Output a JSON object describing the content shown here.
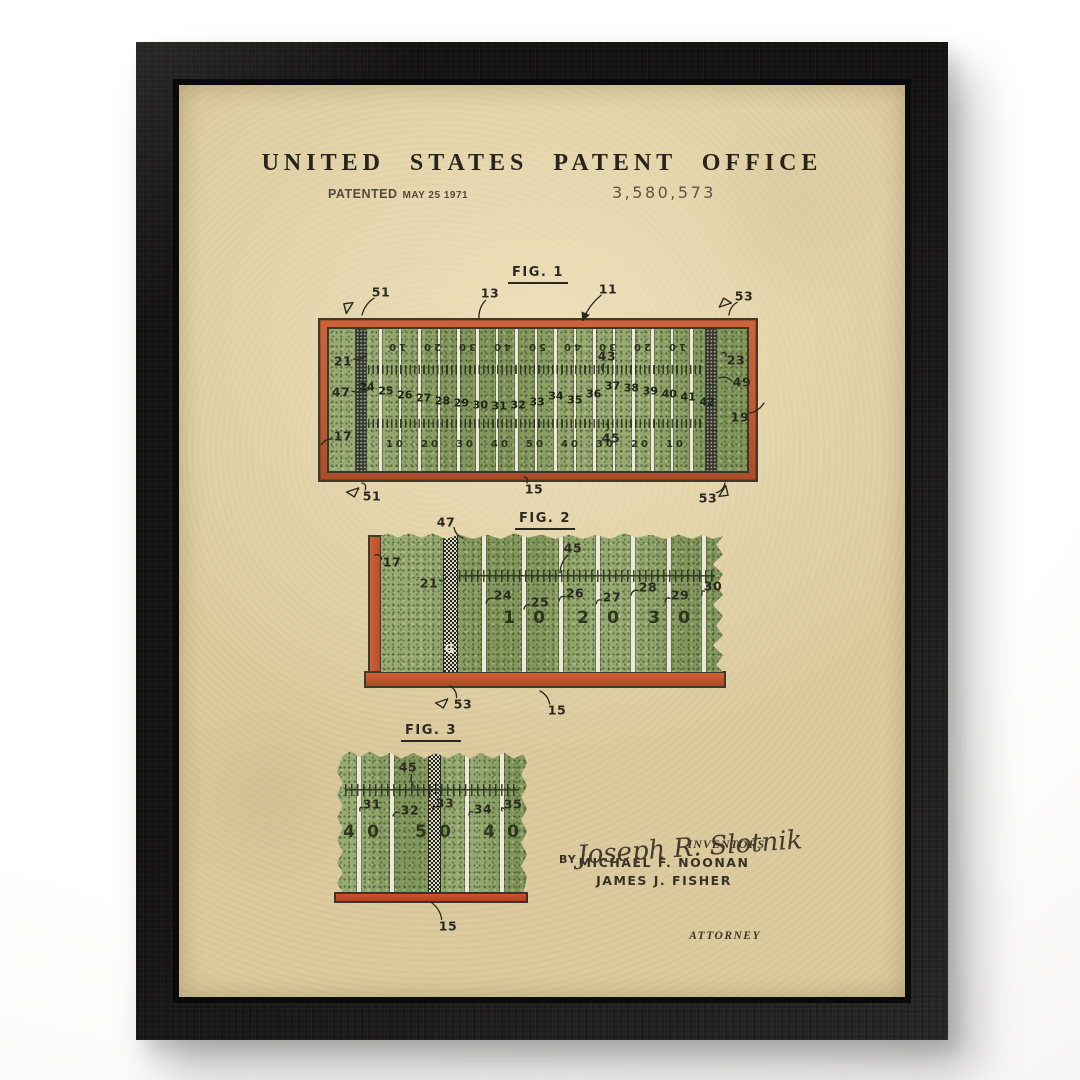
{
  "colors": {
    "frame_black": "#1b1a18",
    "paper_tan": "#dccb9f",
    "field_green": "#8ca164",
    "border_orange": "#c65c35",
    "ink_dark": "#2c2820",
    "line_cream": "#ece9d8",
    "goal_stripe_dark": "#31332a"
  },
  "header": {
    "title": "UNITED STATES PATENT OFFICE",
    "patented_label": "PATENTED",
    "patented_date": "MAY 25 1971",
    "patent_number": "3,580,573"
  },
  "figures": {
    "fig1": {
      "label": "FIG. 1",
      "top_yard_numbers": [
        "10",
        "20",
        "30",
        "40",
        "50",
        "40",
        "30",
        "20",
        "10"
      ],
      "bottom_yard_numbers": [
        "10",
        "20",
        "30",
        "40",
        "50",
        "40",
        "30",
        "20",
        "10"
      ],
      "mid_reference_numbers": [
        "24",
        "25",
        "26",
        "27",
        "28",
        "29",
        "30",
        "31",
        "32",
        "33",
        "34",
        "35",
        "36",
        "37",
        "38",
        "39",
        "40",
        "41",
        "42"
      ],
      "callouts": [
        {
          "t": "51",
          "x": 202,
          "y": 207,
          "tx": 183,
          "ty": 230
        },
        {
          "t": "13",
          "x": 311,
          "y": 208,
          "tx": 300,
          "ty": 233
        },
        {
          "t": "11",
          "x": 429,
          "y": 204,
          "tx": 404,
          "ty": 235,
          "arrow": true
        },
        {
          "t": "53",
          "x": 565,
          "y": 211,
          "tx": 550,
          "ty": 230
        },
        {
          "t": "21",
          "x": 164,
          "y": 276,
          "tx": 187,
          "ty": 270
        },
        {
          "t": "47",
          "x": 162,
          "y": 307,
          "tx": 191,
          "ty": 304
        },
        {
          "t": "17",
          "x": 164,
          "y": 351,
          "tx": 142,
          "ty": 360
        },
        {
          "t": "23",
          "x": 557,
          "y": 275,
          "tx": 543,
          "ty": 268
        },
        {
          "t": "49",
          "x": 563,
          "y": 297,
          "tx": 540,
          "ty": 293
        },
        {
          "t": "19",
          "x": 561,
          "y": 332,
          "tx": 585,
          "ty": 318
        },
        {
          "t": "43",
          "x": 428,
          "y": 271,
          "tx": 424,
          "ty": 286
        },
        {
          "t": "45",
          "x": 432,
          "y": 353,
          "tx": 427,
          "ty": 339
        },
        {
          "t": "51",
          "x": 193,
          "y": 411,
          "tx": 183,
          "ty": 398
        },
        {
          "t": "15",
          "x": 355,
          "y": 404,
          "tx": 345,
          "ty": 392
        },
        {
          "t": "53",
          "x": 529,
          "y": 413,
          "tx": 546,
          "ty": 398
        }
      ]
    },
    "fig2": {
      "label": "FIG. 2",
      "goal_line_letter": "G",
      "yard_numbers": [
        "10",
        "20",
        "30"
      ],
      "callouts": [
        {
          "t": "47",
          "x": 267,
          "y": 437,
          "tx": 284,
          "ty": 453
        },
        {
          "t": "17",
          "x": 213,
          "y": 477,
          "tx": 196,
          "ty": 470
        },
        {
          "t": "21",
          "x": 250,
          "y": 498,
          "tx": 267,
          "ty": 492
        },
        {
          "t": "45",
          "x": 394,
          "y": 463,
          "tx": 381,
          "ty": 488
        },
        {
          "t": "24",
          "x": 324,
          "y": 510,
          "tx": 307,
          "ty": 518
        },
        {
          "t": "25",
          "x": 361,
          "y": 517,
          "tx": 345,
          "ty": 524
        },
        {
          "t": "26",
          "x": 396,
          "y": 508,
          "tx": 380,
          "ty": 516
        },
        {
          "t": "27",
          "x": 433,
          "y": 512,
          "tx": 417,
          "ty": 519
        },
        {
          "t": "28",
          "x": 469,
          "y": 502,
          "tx": 452,
          "ty": 510
        },
        {
          "t": "29",
          "x": 501,
          "y": 510,
          "tx": 486,
          "ty": 517
        },
        {
          "t": "30",
          "x": 534,
          "y": 501,
          "tx": 523,
          "ty": 510
        },
        {
          "t": "53",
          "x": 284,
          "y": 619,
          "tx": 271,
          "ty": 601
        },
        {
          "t": "15",
          "x": 378,
          "y": 625,
          "tx": 361,
          "ty": 606
        }
      ]
    },
    "fig3": {
      "label": "FIG. 3",
      "yard_numbers": [
        "40",
        "50",
        "40"
      ],
      "callouts": [
        {
          "t": "45",
          "x": 229,
          "y": 682,
          "tx": 236,
          "ty": 702
        },
        {
          "t": "31",
          "x": 193,
          "y": 719,
          "tx": 181,
          "ty": 726
        },
        {
          "t": "32",
          "x": 231,
          "y": 725,
          "tx": 214,
          "ty": 731
        },
        {
          "t": "33",
          "x": 266,
          "y": 718,
          "tx": 254,
          "ty": 725
        },
        {
          "t": "34",
          "x": 304,
          "y": 724,
          "tx": 290,
          "ty": 730
        },
        {
          "t": "35",
          "x": 334,
          "y": 719,
          "tx": 323,
          "ty": 726
        },
        {
          "t": "15",
          "x": 269,
          "y": 841,
          "tx": 253,
          "ty": 818
        }
      ]
    }
  },
  "flags": [
    {
      "x": 171,
      "y": 221,
      "r": -20
    },
    {
      "x": 546,
      "y": 218,
      "r": 20
    },
    {
      "x": 174,
      "y": 401,
      "r": -160
    },
    {
      "x": 543,
      "y": 402,
      "r": 160
    },
    {
      "x": 263,
      "y": 612,
      "r": -160
    }
  ],
  "signatures": {
    "inventors_label": "INVENTORS",
    "inventor_names": [
      "MICHAEL F. NOONAN",
      "JAMES J. FISHER"
    ],
    "by_label": "BY",
    "attorney_signature": "Joseph R. Slotnik",
    "attorney_label": "ATTORNEY"
  }
}
